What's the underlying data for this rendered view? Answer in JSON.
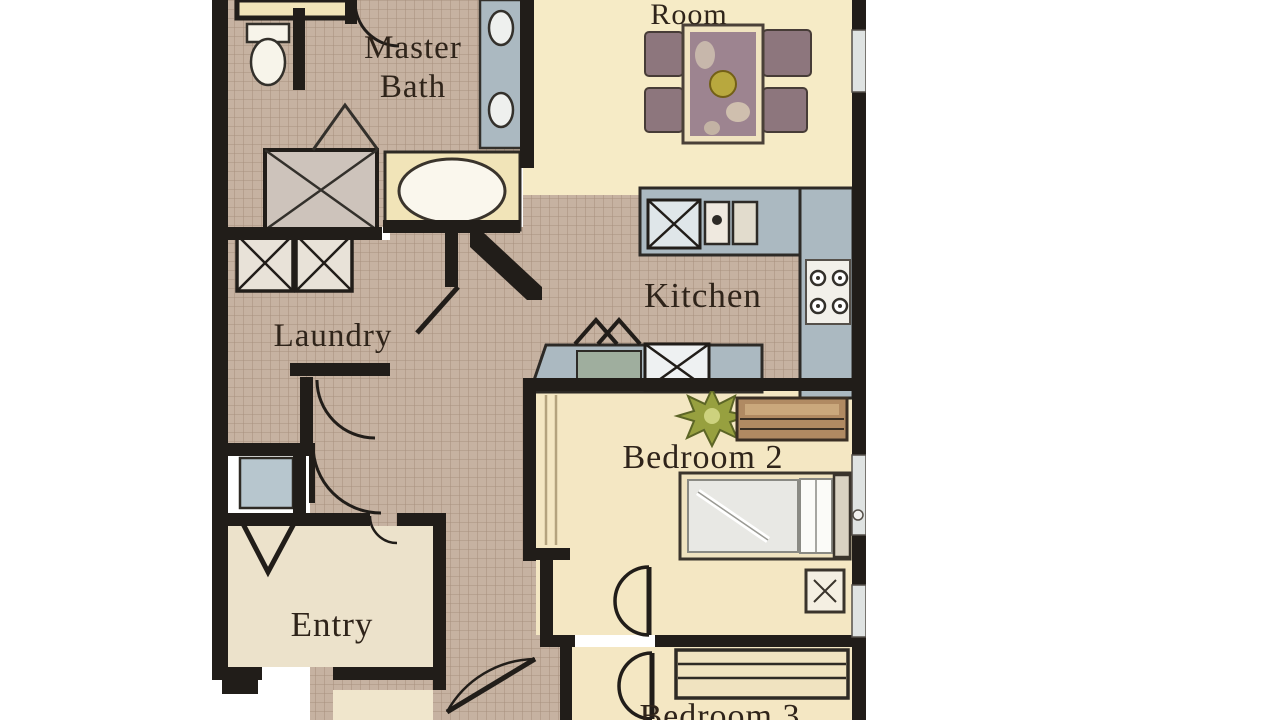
{
  "floorplan": {
    "labels": {
      "room": "Room",
      "master_bath_line1": "Master",
      "master_bath_line2": "Bath",
      "kitchen": "Kitchen",
      "laundry": "Laundry",
      "bedroom2": "Bedroom 2",
      "entry": "Entry",
      "bedroom3": "Bedroom 3"
    },
    "colors": {
      "background": "#ffffff",
      "wall": "#211d19",
      "tile_floor": "#c6b2a1",
      "tile_line": "#a8917e",
      "cream_floor": "#f4e7c3",
      "entry_floor": "#ece2cb",
      "counter": "#abb9c1",
      "counter_inset": "#9fae9e",
      "fixture_white": "#f7f4ea",
      "cabinet_cream": "#f1e4b8",
      "closet_glass": "#b7c6ce",
      "chair": "#8d767d",
      "table_top": "#9d8490",
      "dresser_wood": "#b08a62",
      "plant_green": "#97a03f",
      "text": "#2f241a"
    },
    "symbols": [
      "toilet-icon",
      "shower-icon",
      "bathtub-icon",
      "double-vanity-icon",
      "washer-icon",
      "dryer-icon",
      "dining-table-icon",
      "dining-chair-icon",
      "kitchen-sink-icon",
      "dishwasher-icon",
      "cooktop-icon",
      "bar-sink-icon",
      "cabinet-icon",
      "plant-icon",
      "dresser-icon",
      "bed-icon",
      "nightstand-icon",
      "door-swing-icon",
      "window-icon"
    ]
  }
}
